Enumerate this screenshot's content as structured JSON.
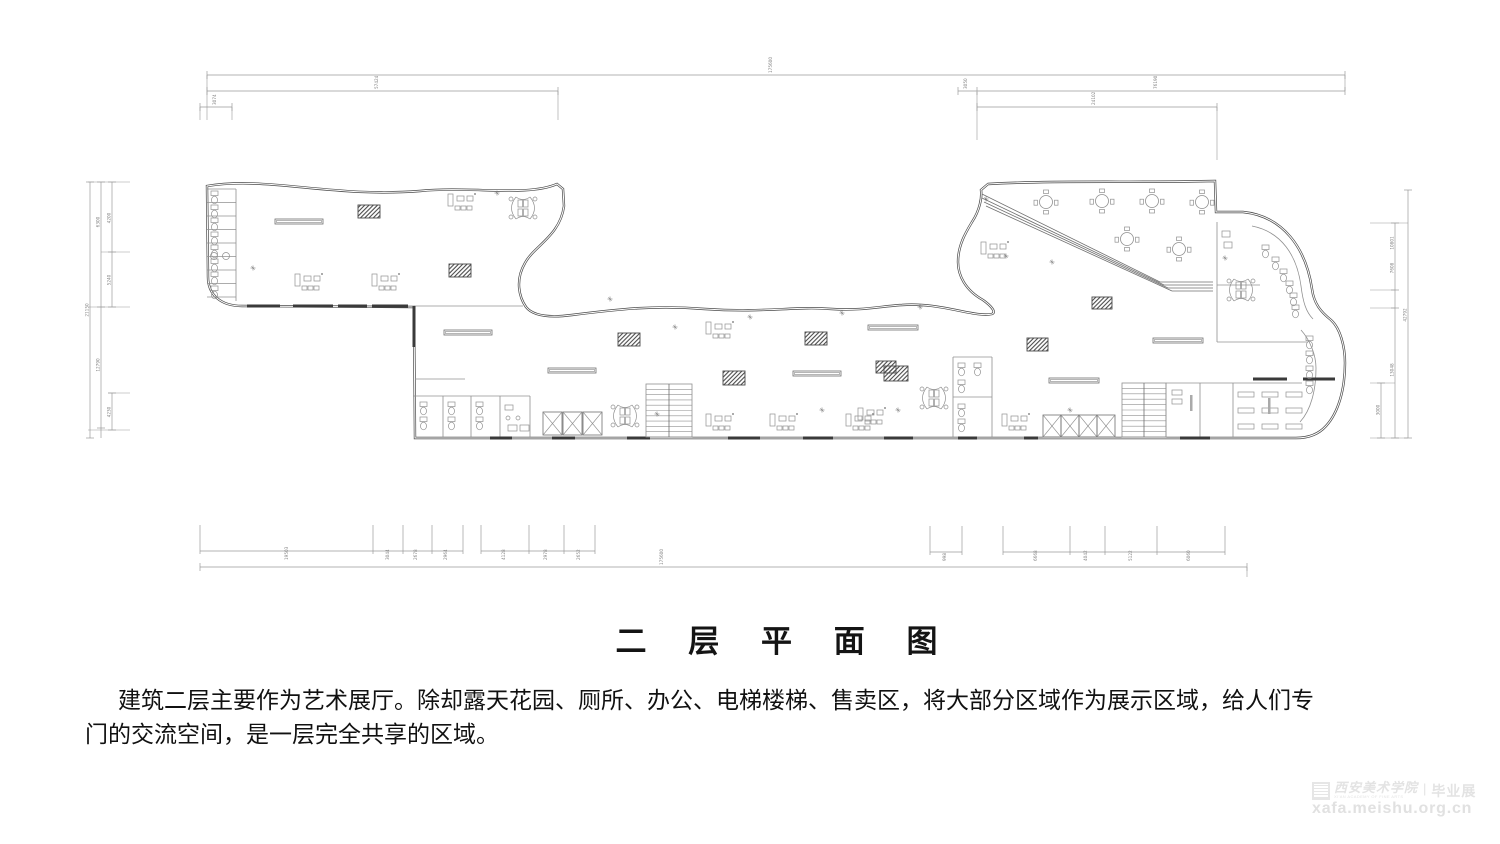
{
  "title": {
    "text": "二 层 平 面 图"
  },
  "description": {
    "line1": "建筑二层主要作为艺术展厅。除却露天花园、厕所、办公、电梯楼梯、售卖区，将大部分区域作为展示区域，给人们专",
    "line2": "门的交流空间，是一层完全共享的区域。"
  },
  "watermark": {
    "org": "西安美术学院",
    "org_en": "XI'AN ACADEMY OF FINE ARTS",
    "separator": "|",
    "suffix": "毕业展",
    "url": "xafa.meishu.org.cn",
    "color": "#e3e3e3"
  },
  "plan": {
    "colors": {
      "stroke": "#4a4a4a",
      "mid": "#6f6f6f",
      "light": "#909090",
      "dark": "#3a3a3a",
      "dim": "#9a9a9a",
      "dimText": "#828282"
    },
    "outline": "M207,186 C268,176 332,198 420,191 C472,186 527,197 557,184 L563,189 L564,206 C560,236 534,246 525,263 C515,280 519,297 526,307 C533,316 549,318 572,315 C620,309 655,305 705,309 C765,313 795,306 832,309 C862,311 882,306 902,305 C940,302 975,318 992,314 C997,312 990,305 983,300 C965,290 958,275 958,262 C958,245 966,232 972,222 C980,210 982,197 981,190 L988,184 C1060,180 1140,183 1215,181 L1216,212 L1243,212 C1283,216 1306,248 1312,289 C1314,304 1321,312 1331,320 C1340,328 1345,346 1345,363 C1345,390 1338,413 1326,426 C1318,435 1308,438 1296,438 L415,438 L414,307 L242,306 C221,306 208,295 208,277 Z",
    "innerWalls": [
      [
        207,
        189,
        236,
        189
      ],
      [
        207,
        202.5,
        236,
        202.5
      ],
      [
        207,
        216,
        236,
        216
      ],
      [
        207,
        229.5,
        236,
        229.5
      ],
      [
        207,
        243,
        236,
        243
      ],
      [
        207,
        256.5,
        236,
        256.5
      ],
      [
        207,
        270,
        236,
        270
      ],
      [
        207,
        283.5,
        236,
        283.5
      ],
      [
        207,
        297,
        236,
        297
      ],
      [
        236,
        189,
        236,
        301
      ],
      [
        414,
        306,
        523,
        306
      ],
      [
        413,
        396,
        530,
        396
      ],
      [
        443,
        396,
        443,
        437
      ],
      [
        471,
        396,
        471,
        437
      ],
      [
        500,
        396,
        500,
        437
      ],
      [
        530,
        396,
        530,
        437
      ],
      [
        415,
        379,
        465,
        379
      ],
      [
        953,
        357,
        992,
        357
      ],
      [
        953,
        357,
        953,
        437
      ],
      [
        992,
        357,
        992,
        437
      ],
      [
        953,
        397,
        992,
        397
      ],
      [
        1166,
        383,
        1166,
        437
      ],
      [
        1166,
        383,
        1233,
        383
      ],
      [
        1200,
        383,
        1200,
        437
      ],
      [
        1233,
        383,
        1233,
        437
      ],
      [
        1233,
        383,
        1302,
        383
      ],
      [
        1217,
        222,
        1217,
        342
      ],
      [
        1217,
        285,
        1260,
        285
      ],
      [
        1217,
        342,
        1308,
        342
      ]
    ],
    "innerPaths": [
      "M1252,226 C1282,232 1297,256 1301,286 C1303,302 1306,312 1313,319",
      "M1301,330 C1310,340 1316,355 1316,368 C1316,390 1311,410 1300,422"
    ],
    "darkWalls": [
      [
        247,
        306,
        280,
        306
      ],
      [
        293,
        306,
        333,
        306
      ],
      [
        338,
        306,
        367,
        306
      ],
      [
        372,
        306,
        408,
        306
      ],
      [
        414,
        306,
        414,
        347
      ],
      [
        490,
        438,
        512,
        438
      ],
      [
        552,
        438,
        575,
        438
      ],
      [
        627,
        438,
        650,
        438
      ],
      [
        728,
        438,
        760,
        438
      ],
      [
        803,
        438,
        833,
        438
      ],
      [
        884,
        438,
        913,
        438
      ],
      [
        958,
        438,
        977,
        438
      ],
      [
        1024,
        438,
        1038,
        438
      ],
      [
        1180,
        438,
        1210,
        438
      ],
      [
        1253,
        379,
        1287,
        379
      ],
      [
        1303,
        379,
        1335,
        379
      ]
    ],
    "hatches": [
      [
        358,
        205,
        22,
        13
      ],
      [
        449,
        264,
        22,
        13
      ],
      [
        618,
        333,
        22,
        13
      ],
      [
        723,
        371,
        22,
        14
      ],
      [
        805,
        332,
        22,
        13
      ],
      [
        876,
        361,
        20,
        12
      ],
      [
        884,
        366,
        24,
        15
      ],
      [
        1027,
        338,
        21,
        13
      ],
      [
        1092,
        297,
        20,
        12
      ]
    ],
    "benches": [
      [
        275,
        219,
        48
      ],
      [
        444,
        330,
        48
      ],
      [
        548,
        368,
        48
      ],
      [
        793,
        371,
        48
      ],
      [
        868,
        325,
        50
      ],
      [
        1049,
        378,
        50
      ],
      [
        1153,
        338,
        50
      ]
    ],
    "tables": [
      [
        1046,
        202
      ],
      [
        1102,
        201
      ],
      [
        1152,
        201
      ],
      [
        1202,
        202
      ],
      [
        1127,
        239
      ],
      [
        1179,
        249
      ]
    ],
    "clusters": [
      [
        295,
        272
      ],
      [
        372,
        272
      ],
      [
        448,
        192
      ],
      [
        706,
        320
      ],
      [
        981,
        240
      ],
      [
        706,
        412
      ],
      [
        770,
        412
      ],
      [
        846,
        412
      ],
      [
        1002,
        412
      ],
      [
        858,
        406
      ]
    ],
    "butterflies": [
      [
        523,
        208
      ],
      [
        625,
        416
      ],
      [
        934,
        398
      ],
      [
        1241,
        290
      ]
    ],
    "lifts": [
      [
        543,
        412,
        19,
        23
      ],
      [
        563,
        412,
        19,
        23
      ],
      [
        583,
        412,
        19,
        23
      ],
      [
        1043,
        415,
        18,
        22
      ],
      [
        1061,
        415,
        18,
        22
      ],
      [
        1079,
        415,
        18,
        22
      ],
      [
        1097,
        415,
        18,
        22
      ]
    ],
    "stairs": [
      [
        646,
        384,
        46,
        53
      ],
      [
        1122,
        383,
        44,
        54
      ]
    ],
    "ramp": [
      [
        982,
        194,
        1160,
        282
      ],
      [
        982,
        198,
        1164,
        285
      ],
      [
        984,
        202,
        1168,
        288
      ],
      [
        986,
        206,
        1172,
        291
      ],
      [
        1160,
        282,
        1213,
        282
      ],
      [
        1164,
        285,
        1213,
        285
      ],
      [
        1168,
        288,
        1213,
        288
      ],
      [
        1172,
        291,
        1213,
        291
      ]
    ],
    "fixtures": [
      [
        211,
        191
      ],
      [
        211,
        205
      ],
      [
        211,
        218
      ],
      [
        211,
        232
      ],
      [
        211,
        245
      ],
      [
        211,
        259
      ],
      [
        211,
        272
      ],
      [
        211,
        286
      ],
      [
        420,
        402
      ],
      [
        420,
        417
      ],
      [
        448,
        402
      ],
      [
        448,
        417
      ],
      [
        476,
        402
      ],
      [
        476,
        417
      ],
      [
        958,
        363
      ],
      [
        974,
        363
      ],
      [
        958,
        380
      ],
      [
        958,
        404
      ],
      [
        958,
        419
      ],
      [
        1262,
        245
      ],
      [
        1272,
        257
      ],
      [
        1280,
        269
      ],
      [
        1286,
        281
      ],
      [
        1290,
        293
      ],
      [
        1292,
        305
      ],
      [
        1306,
        336
      ],
      [
        1306,
        351
      ],
      [
        1306,
        366
      ],
      [
        1306,
        381
      ]
    ],
    "circles": [
      [
        214,
        256,
        3.5
      ],
      [
        226,
        256,
        3.5
      ],
      [
        508,
        418,
        2
      ],
      [
        518,
        418,
        2
      ]
    ],
    "desks": [
      [
        508,
        425,
        9,
        6
      ],
      [
        520,
        425,
        9,
        6
      ],
      [
        505,
        405,
        8,
        5
      ],
      [
        1238,
        392,
        16,
        5
      ],
      [
        1262,
        392,
        16,
        5
      ],
      [
        1286,
        392,
        16,
        5
      ],
      [
        1238,
        408,
        16,
        5
      ],
      [
        1262,
        408,
        16,
        5
      ],
      [
        1286,
        408,
        16,
        5
      ],
      [
        1238,
        424,
        16,
        5
      ],
      [
        1262,
        424,
        16,
        5
      ],
      [
        1286,
        424,
        16,
        5
      ],
      [
        1172,
        390,
        10,
        5
      ],
      [
        1172,
        399,
        10,
        5
      ],
      [
        1222,
        231,
        8,
        6
      ],
      [
        1224,
        242,
        8,
        6
      ]
    ],
    "labelBars": [
      [
        1190,
        395
      ],
      [
        1268,
        398
      ]
    ],
    "plants": [
      [
        497,
        193
      ],
      [
        610,
        299
      ],
      [
        675,
        327
      ],
      [
        750,
        317
      ],
      [
        842,
        313
      ],
      [
        920,
        307
      ],
      [
        986,
        199
      ],
      [
        1006,
        256
      ],
      [
        1052,
        262
      ],
      [
        657,
        414
      ],
      [
        822,
        410
      ],
      [
        898,
        410
      ],
      [
        1070,
        410
      ],
      [
        253,
        268
      ],
      [
        1225,
        258
      ]
    ],
    "dims": {
      "hchains": [
        {
          "y": 75,
          "x1": 207,
          "x2": 1345,
          "ticks": [
            207,
            1345
          ],
          "labels": [
            [
              772,
              "175600"
            ]
          ]
        },
        {
          "y": 91,
          "x1": 207,
          "x2": 558,
          "ticks": [
            207,
            558
          ],
          "labels": [
            [
              378,
              "57424"
            ]
          ]
        },
        {
          "y": 91,
          "x1": 958,
          "x2": 1345,
          "ticks": [
            958,
            977,
            1345
          ],
          "labels": [
            [
              967,
              "3050"
            ],
            [
              1157,
              "76190"
            ]
          ]
        },
        {
          "y": 107,
          "x1": 200,
          "x2": 232,
          "ticks": [
            200,
            232
          ],
          "labels": [
            [
              216,
              "3074"
            ]
          ]
        },
        {
          "y": 107,
          "x1": 977,
          "x2": 1217,
          "ticks": [
            977,
            1217
          ],
          "labels": [
            [
              1095,
              "24102"
            ]
          ]
        },
        {
          "y": 551,
          "x1": 200,
          "x2": 463,
          "ticks": [
            200,
            373,
            403,
            432,
            463
          ],
          "up": 525,
          "labels": [
            [
              288,
              "19503"
            ],
            [
              389,
              "3044"
            ],
            [
              417,
              "2678"
            ],
            [
              447,
              "2964"
            ]
          ]
        },
        {
          "y": 551,
          "x1": 481,
          "x2": 595,
          "ticks": [
            481,
            529,
            564,
            595
          ],
          "up": 525,
          "labels": [
            [
              505,
              "4128"
            ],
            [
              547,
              "2978"
            ],
            [
              580,
              "2652"
            ]
          ]
        },
        {
          "y": 552,
          "x1": 930,
          "x2": 962,
          "ticks": [
            930,
            962
          ],
          "up": 526,
          "labels": [
            [
              946,
              "998"
            ]
          ]
        },
        {
          "y": 552,
          "x1": 1003,
          "x2": 1225,
          "ticks": [
            1003,
            1070,
            1105,
            1157,
            1225
          ],
          "up": 526,
          "labels": [
            [
              1037,
              "6668"
            ],
            [
              1087,
              "4042"
            ],
            [
              1132,
              "5122"
            ],
            [
              1190,
              "6060"
            ]
          ]
        },
        {
          "y": 567,
          "x1": 200,
          "x2": 1247,
          "ticks": [
            200,
            1247
          ],
          "labels": [
            [
              663,
              "175600"
            ]
          ]
        }
      ],
      "vchains": [
        {
          "x": 90,
          "y1": 182,
          "y2": 438,
          "ticks": [
            182,
            438
          ],
          "labels": [
            [
              310,
              "21150"
            ]
          ]
        },
        {
          "x": 101,
          "y1": 182,
          "y2": 438,
          "ticks": [
            182,
            307,
            428
          ],
          "labels": [
            [
              222,
              "6300"
            ],
            [
              365,
              "12790"
            ]
          ]
        },
        {
          "x": 112,
          "y1": 182,
          "y2": 307,
          "ticks": [
            182,
            252,
            307
          ],
          "labels": [
            [
              218,
              "4200"
            ],
            [
              280,
              "5240"
            ]
          ]
        },
        {
          "x": 112,
          "y1": 393,
          "y2": 430,
          "ticks": [
            393,
            430
          ],
          "labels": [
            [
              412,
              "4230"
            ]
          ]
        },
        {
          "x": 1408,
          "y1": 190,
          "y2": 438,
          "ticks": [
            190,
            438
          ],
          "labels": [
            [
              315,
              "42792"
            ]
          ]
        },
        {
          "x": 1395,
          "y1": 223,
          "y2": 438,
          "ticks": [
            223,
            290,
            308,
            438
          ],
          "labels": [
            [
              243,
              "10801"
            ],
            [
              268,
              "7608"
            ],
            [
              370,
              "13048"
            ]
          ]
        },
        {
          "x": 1381,
          "y1": 383,
          "y2": 438,
          "ticks": [
            383,
            438
          ],
          "labels": [
            [
              410,
              "3000"
            ]
          ]
        }
      ],
      "stubs": [
        [
          207,
          75,
          207,
          120
        ],
        [
          1345,
          75,
          1345,
          91
        ],
        [
          558,
          91,
          558,
          120
        ],
        [
          200,
          107,
          200,
          120
        ],
        [
          232,
          107,
          232,
          120
        ],
        [
          977,
          92,
          977,
          140
        ],
        [
          1217,
          107,
          1217,
          160
        ],
        [
          88,
          182,
          130,
          182
        ],
        [
          101,
          252,
          130,
          252
        ],
        [
          88,
          307,
          130,
          307
        ],
        [
          108,
          393,
          130,
          393
        ],
        [
          88,
          430,
          130,
          430
        ],
        [
          1370,
          223,
          1408,
          223
        ],
        [
          1370,
          290,
          1395,
          290
        ],
        [
          1370,
          308,
          1395,
          308
        ],
        [
          1370,
          383,
          1395,
          383
        ],
        [
          1370,
          438,
          1408,
          438
        ],
        [
          1247,
          567,
          1247,
          577
        ]
      ]
    }
  }
}
